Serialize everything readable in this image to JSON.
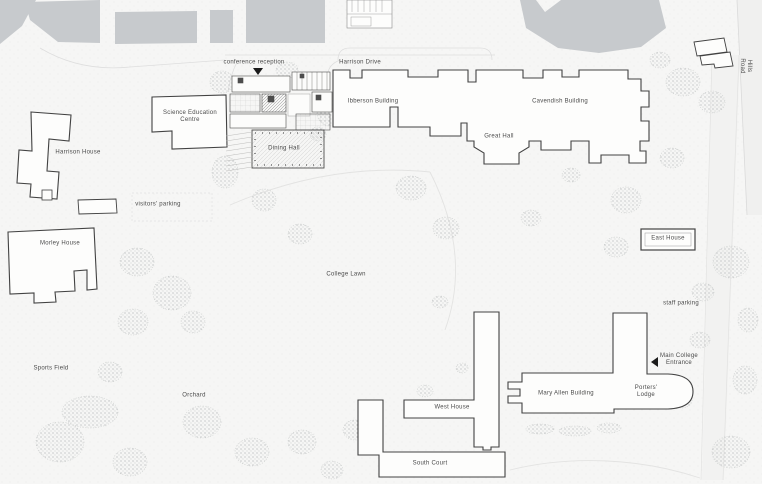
{
  "map": {
    "colors": {
      "background": "#f6f6f5",
      "context_building": "#c7cacd",
      "building_outline": "#424242",
      "label_text": "#4a4a4a",
      "tree_stipple": "#b7baba",
      "road": "#f0f0ef",
      "marker": "#1a1a1a"
    },
    "labels": [
      {
        "id": "conference-reception",
        "text": "conference reception",
        "x": 254,
        "y": 63
      },
      {
        "id": "harrison-drive",
        "text": "Harrison Drive",
        "x": 360,
        "y": 63
      },
      {
        "id": "ibberson-building",
        "text": "Ibberson Building",
        "x": 373,
        "y": 102
      },
      {
        "id": "cavendish-building",
        "text": "Cavendish Building",
        "x": 560,
        "y": 102
      },
      {
        "id": "great-hall",
        "text": "Great Hall",
        "x": 499,
        "y": 137
      },
      {
        "id": "dining-hall",
        "text": "Dining Hall",
        "x": 284,
        "y": 149
      },
      {
        "id": "science-education-centre",
        "text": "Science Education\nCentre",
        "x": 190,
        "y": 117
      },
      {
        "id": "harrison-house",
        "text": "Harrison House",
        "x": 78,
        "y": 153
      },
      {
        "id": "visitors-parking",
        "text": "visitors' parking",
        "x": 158,
        "y": 205
      },
      {
        "id": "morley-house",
        "text": "Morley House",
        "x": 60,
        "y": 244
      },
      {
        "id": "college-lawn",
        "text": "College Lawn",
        "x": 346,
        "y": 275
      },
      {
        "id": "east-house",
        "text": "East House",
        "x": 668,
        "y": 239
      },
      {
        "id": "staff-parking",
        "text": "staff parking",
        "x": 681,
        "y": 304
      },
      {
        "id": "main-college-entrance",
        "text": "Main College\nEntrance",
        "x": 679,
        "y": 360
      },
      {
        "id": "porters-lodge",
        "text": "Porters'\nLodge",
        "x": 646,
        "y": 392
      },
      {
        "id": "mary-allen-building",
        "text": "Mary Allen Building",
        "x": 566,
        "y": 394
      },
      {
        "id": "west-house",
        "text": "West House",
        "x": 452,
        "y": 408
      },
      {
        "id": "south-court",
        "text": "South Court",
        "x": 430,
        "y": 464
      },
      {
        "id": "orchard",
        "text": "Orchard",
        "x": 194,
        "y": 396
      },
      {
        "id": "sports-field",
        "text": "Sports Field",
        "x": 51,
        "y": 369
      },
      {
        "id": "hills-road",
        "text": "Hills Road",
        "x": 745,
        "y": 66
      }
    ],
    "markers": [
      {
        "id": "conference-reception-arrow",
        "shape": "triangle-down",
        "x": 258,
        "y": 71
      },
      {
        "id": "main-entrance-arrow",
        "shape": "triangle-left",
        "x": 656,
        "y": 362
      }
    ]
  }
}
